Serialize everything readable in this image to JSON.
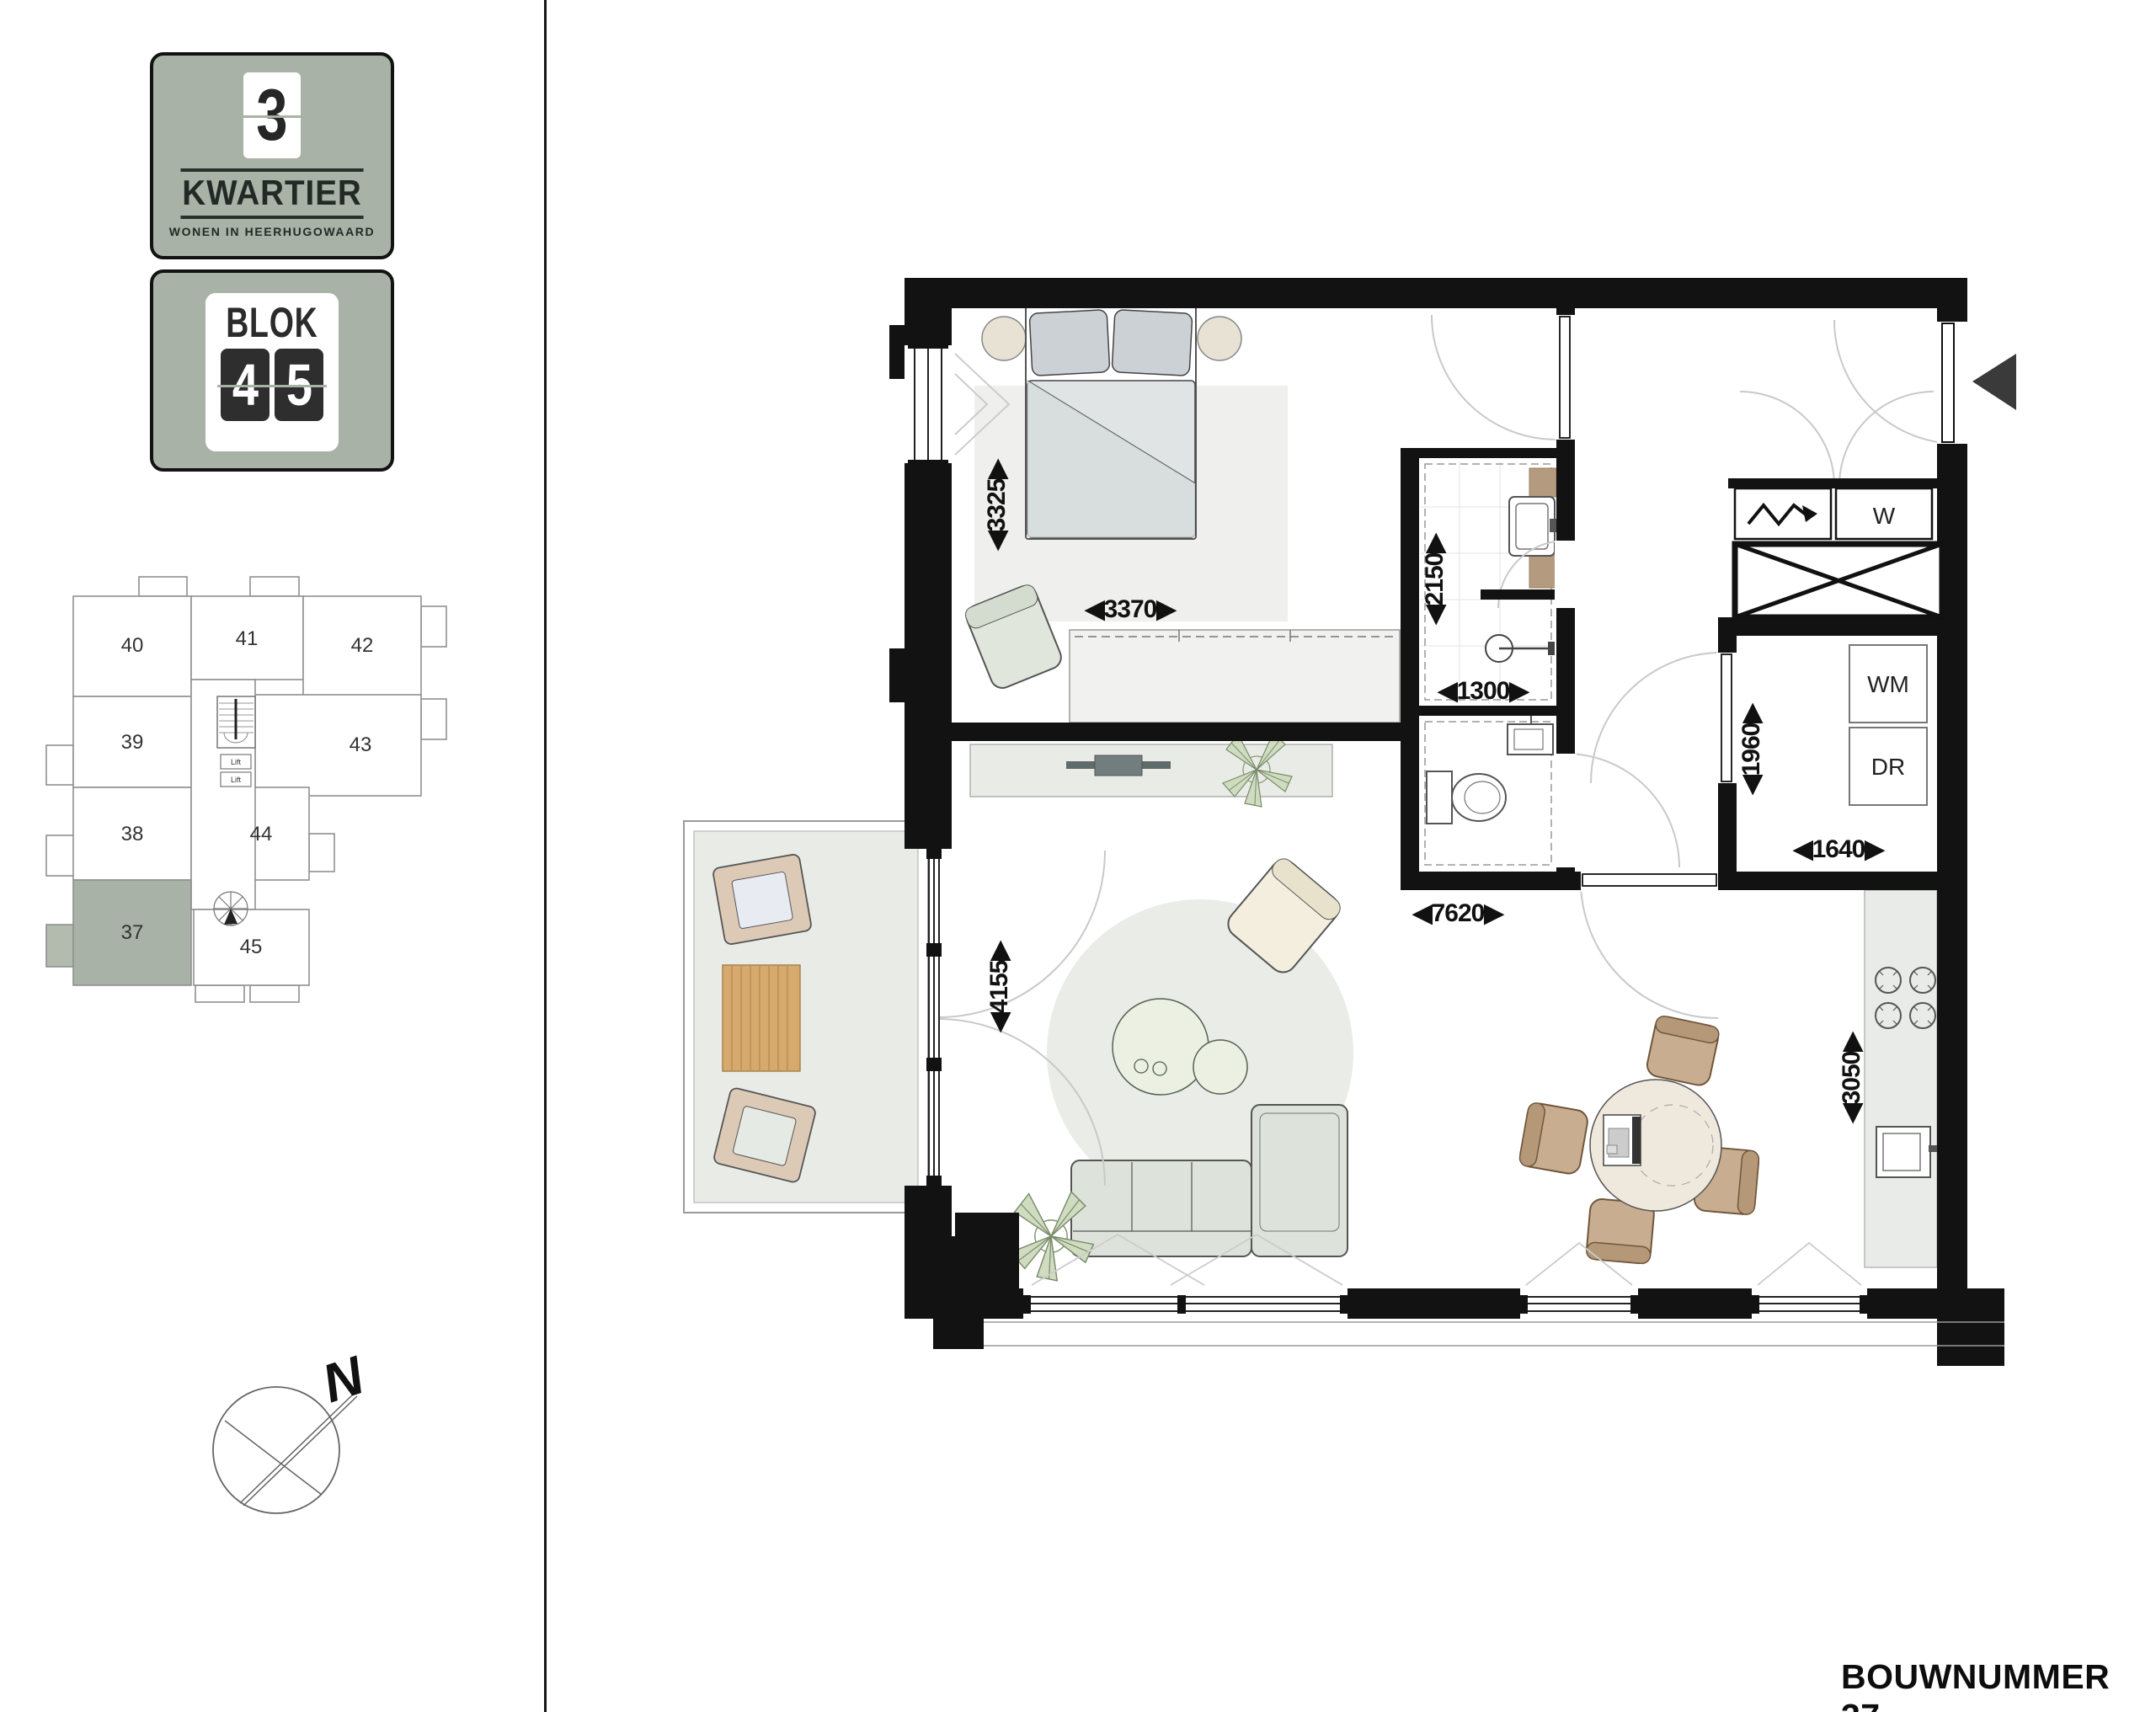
{
  "page": {
    "footer_label": "BOUWNUMMER 37"
  },
  "branding": {
    "project_number": "3",
    "project_name": "KWARTIER",
    "project_tagline": "WONEN IN HEERHUGOWAARD",
    "block_label": "BLOK",
    "block_digits": [
      "4",
      "5"
    ]
  },
  "site_overview": {
    "units": [
      "40",
      "41",
      "42",
      "39",
      "43",
      "38",
      "44",
      "37",
      "45"
    ],
    "highlighted_unit": "37",
    "lift_label": "Lift"
  },
  "compass": {
    "north_label": "N"
  },
  "floor_plan": {
    "appliance_labels": {
      "water_meter": "W",
      "washing_machine": "WM",
      "dryer": "DR"
    },
    "dimensions_mm": {
      "bedroom_depth": "3325",
      "bedroom_width": "3370",
      "bathroom_depth": "2150",
      "bathroom_width": "1300",
      "storage_depth": "1960",
      "storage_width": "1640",
      "living_width": "7620",
      "living_depth": "4155",
      "kitchen_length": "3050"
    }
  },
  "colors": {
    "brand_green": "#a8b2a6",
    "wall_black": "#121212",
    "floor_white": "#ffffff",
    "balcony_floor": "#e9ebe7",
    "wood_deck": "#d6a96c",
    "chair_brown": "#c9ad90",
    "sofa_green": "#dde2da",
    "plant_green": "#cfdcc0"
  }
}
